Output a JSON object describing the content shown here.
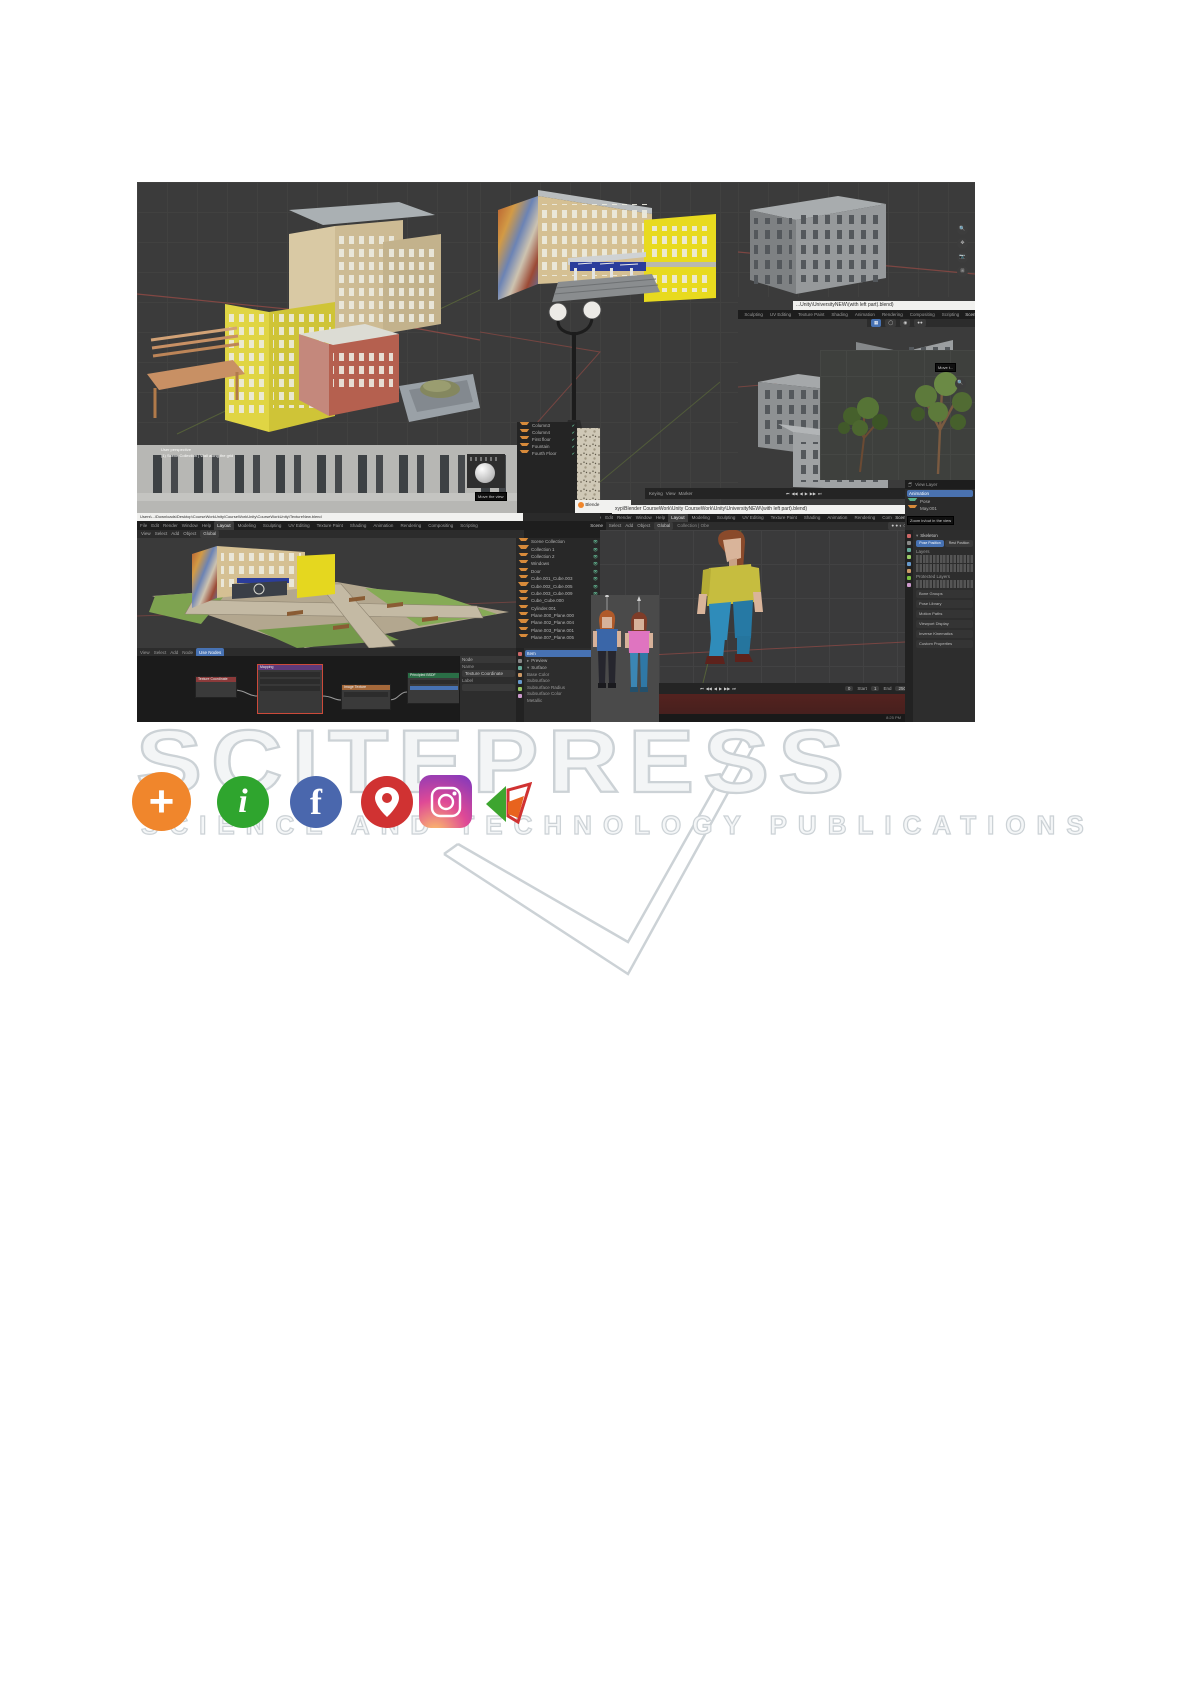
{
  "watermark": {
    "title": "SCITEPRESS",
    "subtitle": "SCIENCE AND TECHNOLOGY PUBLICATIONS",
    "color": "#ccd2d6"
  },
  "social": [
    {
      "name": "share-plus",
      "glyph": "+",
      "color": "#f0862c"
    },
    {
      "name": "info",
      "glyph": "i",
      "color": "#2fa52e"
    },
    {
      "name": "facebook",
      "glyph": "f",
      "color": "#4a67ad"
    },
    {
      "name": "location-pin",
      "color": "#d03232"
    },
    {
      "name": "instagram",
      "color": "#df4996"
    },
    {
      "name": "publisher-logo",
      "color": "#3da52f"
    }
  ],
  "blender": {
    "window_titles": {
      "middle": "...Unity\\UniversityNEW\\(with left part).blend)",
      "bottom": "xyp\\Blender CourseWork\\Unity CourseWork\\Unity\\UniversityNEW\\(with left part).blend)",
      "left": "Users\\...\\Downloads\\Desktop\\CourseWorkUnity\\CourseWorkUnity\\CourseWorkUnity\\TextureNew.blend"
    },
    "window_buttons": "—  ❐  ✕",
    "menus": [
      "File",
      "Edit",
      "Render",
      "Window",
      "Help"
    ],
    "workspace_tabs": [
      "Layout",
      "Modeling",
      "Sculpting",
      "UV Editing",
      "Texture Paint",
      "Shading",
      "Animation",
      "Rendering",
      "Compositing",
      "Scripting"
    ],
    "active_tab": "Layout",
    "scene_label": "Scene",
    "view_layer_label": "View Layer",
    "viewport_menus": [
      "View",
      "Select",
      "Add",
      "Object"
    ],
    "orientation": "Global",
    "collection_breadcrumb": "Collection | Obe",
    "timeline": {
      "menus": [
        "Keying",
        "View",
        "Marker"
      ],
      "playback": [
        "⏮",
        "◀◀",
        "◀",
        "▶",
        "▶▶",
        "⏭"
      ],
      "frame": "0",
      "start_label": "Start",
      "start": "1",
      "end_label": "End",
      "end": "250"
    },
    "outliner_small": [
      "Column3",
      "Column4",
      "First floor",
      "Fountain",
      "Fourth Floor"
    ],
    "outliner_main": [
      "Scene Collection",
      "Collection 1",
      "Collection 2",
      "Windows",
      "Door",
      "Cube.001_Cube.003",
      "Cube.002_Cube.005",
      "Cube.003_Cube.009",
      "Cube_Cube.000",
      "Cylinder.001",
      "Plane.000_Plane.000",
      "Plane.002_Plane.004",
      "Plane.003_Plane.001",
      "Plane.007_Plane.005"
    ],
    "material_panel": {
      "item_label": "Item",
      "sections": [
        "Preview",
        "Surface"
      ],
      "fields": [
        "Base Color",
        "Subsurface",
        "Subsurface Radius",
        "Subsurface Color",
        "Metallic"
      ]
    },
    "node_editor": {
      "header_menus": [
        "View",
        "Select",
        "Add",
        "Node"
      ],
      "use_nodes": "Use Nodes",
      "nodes": [
        {
          "label": "Texture Coordinate"
        },
        {
          "label": "Mapping"
        },
        {
          "label": "Image Texture"
        },
        {
          "label": "Principled BSDF"
        },
        {
          "label": "Material Output"
        }
      ],
      "n_panel": {
        "tab": "Node",
        "name_label": "Name",
        "name_value": "Texture Coordinate",
        "label_label": "Label"
      }
    },
    "pose_panel": {
      "items": [
        "Animation",
        "Pose",
        "May.001"
      ],
      "skeleton": "Skeleton",
      "pose_position": "Pose Position",
      "rest_position": "Rest Position",
      "layers_label": "Layers",
      "protected_label": "Protected Layers",
      "sections": [
        "Bone Groups",
        "Pose Library",
        "Motion Paths",
        "Viewport Display",
        "Inverse Kinematics",
        "Custom Properties"
      ]
    },
    "overlay_text": [
      "User perspective",
      "(1) Scene Collection | Wall along the grid"
    ],
    "tooltips": {
      "move_view": "Move the view",
      "move_view_short": "Move t...",
      "zoom_view": "Zoom in/out in the view"
    },
    "status": {
      "left": "Layer Select",
      "time": "8:25 PM"
    },
    "titlebar_fragment": "Blende"
  },
  "colors": {
    "viewport_bg": "#3b3b3b",
    "header_bg": "#1d1d1d",
    "panel_bg": "#2a2a2a",
    "accent_blue": "#4772b3",
    "red_band": "#4e2121",
    "watermark_gray": "#ccd2d6",
    "axis_red": "#8f4a45",
    "axis_green": "#5f6f3a"
  }
}
